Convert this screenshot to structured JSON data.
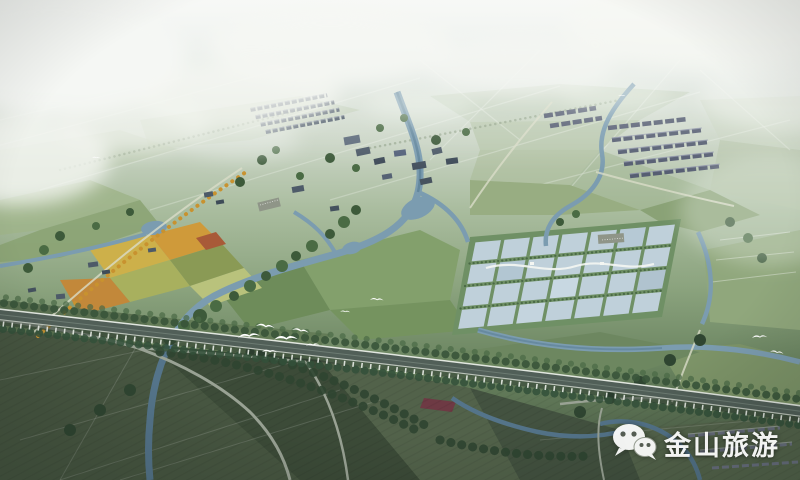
{
  "watermark": {
    "text": "金山旅游",
    "icon": "wechat-icon"
  },
  "scene": {
    "palette": {
      "haze": "#e9eee8",
      "cloud": "#f6f8f4",
      "distant_field": "#c6d2c2",
      "field_green": "#7d9767",
      "field_dark": "#44523f",
      "autumn_tree": "#d8a53f",
      "water": "#7b9cb0",
      "canal_dark": "#54748a",
      "pond": "#bfd0da",
      "dike_green": "#6f9065",
      "roof": "#4d5a68",
      "highway": "#515f58",
      "bird": "#ffffff"
    }
  }
}
